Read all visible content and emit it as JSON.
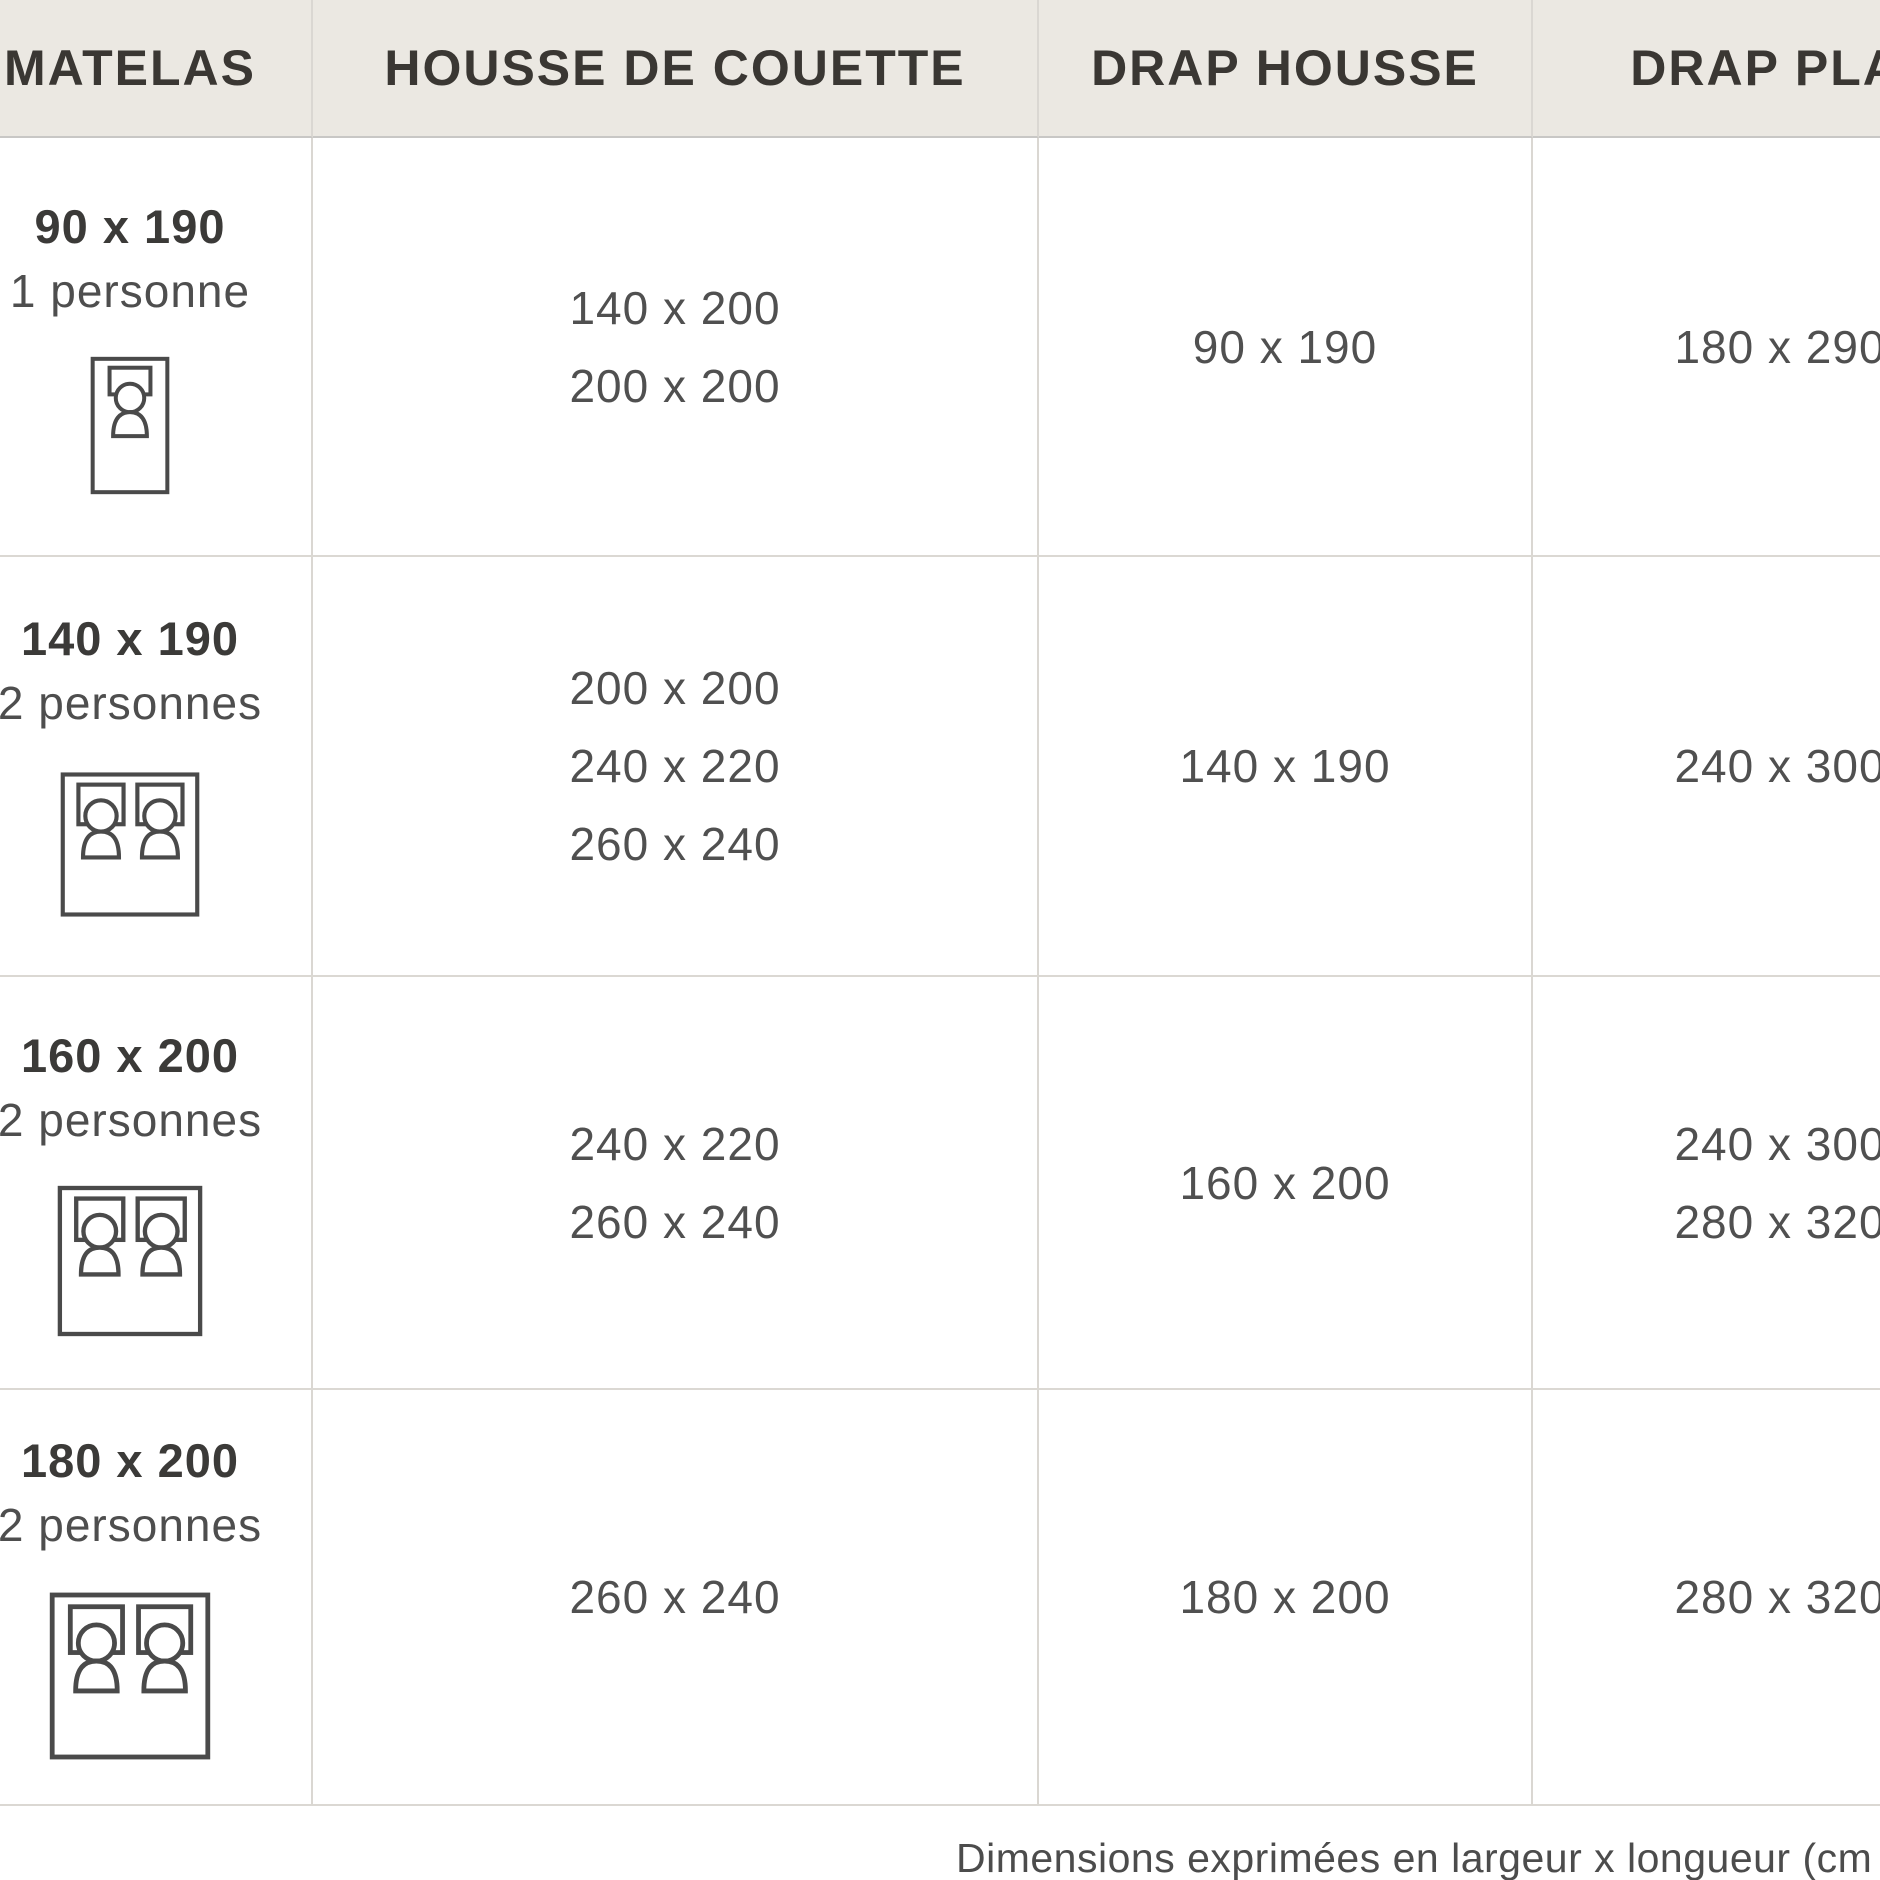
{
  "table": {
    "columns": [
      {
        "label": "MATELAS"
      },
      {
        "label": "HOUSSE DE COUETTE"
      },
      {
        "label": "DRAP HOUSSE"
      },
      {
        "label": "DRAP PLAT"
      }
    ],
    "rows": [
      {
        "matelas": {
          "size": "90 x 190",
          "persons": "1 personne",
          "bed_icon": "single-bed-icon"
        },
        "housse_de_couette": [
          "140 x 200",
          "200 x 200"
        ],
        "drap_housse": [
          "90 x 190"
        ],
        "drap_plat": [
          "180 x 290"
        ]
      },
      {
        "matelas": {
          "size": "140 x 190",
          "persons": "2 personnes",
          "bed_icon": "double-bed-icon"
        },
        "housse_de_couette": [
          "200 x 200",
          "240 x 220",
          "260 x 240"
        ],
        "drap_housse": [
          "140 x 190"
        ],
        "drap_plat": [
          "240 x 300"
        ]
      },
      {
        "matelas": {
          "size": "160 x 200",
          "persons": "2 personnes",
          "bed_icon": "double-bed-icon"
        },
        "housse_de_couette": [
          "240 x 220",
          "260 x 240"
        ],
        "drap_housse": [
          "160 x 200"
        ],
        "drap_plat": [
          "240 x 300",
          "280 x 320"
        ]
      },
      {
        "matelas": {
          "size": "180 x 200",
          "persons": "2 personnes",
          "bed_icon": "double-bed-icon"
        },
        "housse_de_couette": [
          "260 x 240"
        ],
        "drap_housse": [
          "180 x 200"
        ],
        "drap_plat": [
          "280 x 320"
        ]
      }
    ]
  },
  "footer": {
    "note": "Dimensions exprimées en largeur x longueur (cm"
  },
  "colors": {
    "header_bg": "#ebe8e2",
    "border": "#dbd8d3",
    "header_border": "#c8c7c5",
    "header_text": "#3a3733",
    "body_text": "#505050",
    "icon_stroke": "#4a4a4a",
    "background": "#ffffff"
  }
}
